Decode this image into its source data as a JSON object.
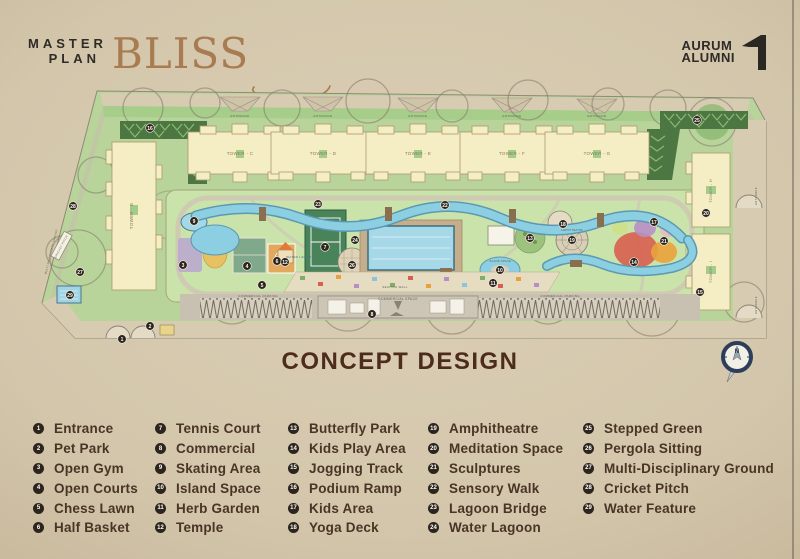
{
  "header": {
    "master_plan_line1": "MASTER",
    "master_plan_line2": "PLAN",
    "brand": "BLISS",
    "logo_line1": "AURUM",
    "logo_line2": "ALUMNI"
  },
  "title": "CONCEPT DESIGN",
  "colors": {
    "brand-gold": "#a87c50",
    "ink": "#2f2b26",
    "title-brown": "#4e2c1c",
    "legend-ink": "#4a3426",
    "marker-bg": "#2d251c",
    "site-green": "#b9d49b",
    "water-blue": "#8ccfe3"
  },
  "map": {
    "markers": [
      {
        "n": 1,
        "x": 122,
        "y": 339
      },
      {
        "n": 2,
        "x": 150,
        "y": 326
      },
      {
        "n": 3,
        "x": 183,
        "y": 265
      },
      {
        "n": 4,
        "x": 247,
        "y": 266
      },
      {
        "n": 5,
        "x": 262,
        "y": 285
      },
      {
        "n": 6,
        "x": 277,
        "y": 261
      },
      {
        "n": 7,
        "x": 325,
        "y": 247
      },
      {
        "n": 8,
        "x": 372,
        "y": 314
      },
      {
        "n": 9,
        "x": 194,
        "y": 221
      },
      {
        "n": 10,
        "x": 500,
        "y": 270
      },
      {
        "n": 11,
        "x": 493,
        "y": 283
      },
      {
        "n": 12,
        "x": 285,
        "y": 262
      },
      {
        "n": 13,
        "x": 530,
        "y": 238
      },
      {
        "n": 14,
        "x": 634,
        "y": 262
      },
      {
        "n": 15,
        "x": 700,
        "y": 292
      },
      {
        "n": 16,
        "x": 150,
        "y": 128
      },
      {
        "n": 17,
        "x": 654,
        "y": 222
      },
      {
        "n": 18,
        "x": 563,
        "y": 224
      },
      {
        "n": 19,
        "x": 572,
        "y": 240
      },
      {
        "n": 20,
        "x": 706,
        "y": 213
      },
      {
        "n": 21,
        "x": 664,
        "y": 241
      },
      {
        "n": 22,
        "x": 445,
        "y": 205
      },
      {
        "n": 23,
        "x": 318,
        "y": 204
      },
      {
        "n": 24,
        "x": 355,
        "y": 240
      },
      {
        "n": 25,
        "x": 697,
        "y": 120
      },
      {
        "n": 26,
        "x": 352,
        "y": 265
      },
      {
        "n": 27,
        "x": 80,
        "y": 272
      },
      {
        "n": 28,
        "x": 73,
        "y": 206
      },
      {
        "n": 29,
        "x": 70,
        "y": 295
      }
    ],
    "labels": [
      {
        "t": "ENTRANCE",
        "x": 240,
        "y": 117,
        "s": 3,
        "c": "#6b6352"
      },
      {
        "t": "ENTRANCE",
        "x": 323,
        "y": 117,
        "s": 3,
        "c": "#6b6352"
      },
      {
        "t": "ENTRANCE",
        "x": 418,
        "y": 117,
        "s": 3,
        "c": "#6b6352"
      },
      {
        "t": "ENTRANCE",
        "x": 512,
        "y": 117,
        "s": 3,
        "c": "#6b6352"
      },
      {
        "t": "ENTRANCE",
        "x": 597,
        "y": 117,
        "s": 3,
        "c": "#6b6352"
      },
      {
        "t": "TOWER - C",
        "x": 240,
        "y": 155,
        "s": 4.5
      },
      {
        "t": "TOWER - D",
        "x": 323,
        "y": 155,
        "s": 4.5
      },
      {
        "t": "TOWER - E",
        "x": 418,
        "y": 155,
        "s": 4.5
      },
      {
        "t": "TOWER - F",
        "x": 512,
        "y": 155,
        "s": 4.5
      },
      {
        "t": "TOWER - G",
        "x": 597,
        "y": 155,
        "s": 4.5
      },
      {
        "t": "TOWER - B",
        "x": 133,
        "y": 216,
        "r": -90,
        "s": 4.5
      },
      {
        "t": "TOWER - H",
        "x": 712,
        "y": 191,
        "r": -90,
        "s": 4
      },
      {
        "t": "TOWER - I",
        "x": 712,
        "y": 272,
        "r": -90,
        "s": 4
      },
      {
        "t": "ENTRANCE",
        "x": 757,
        "y": 196,
        "r": -90,
        "s": 2.8,
        "c": "#6b6352"
      },
      {
        "t": "ENTRANCE",
        "x": 757,
        "y": 305,
        "r": -90,
        "s": 2.8,
        "c": "#6b6352"
      },
      {
        "t": "CRICKET PITCH",
        "x": 62,
        "y": 247,
        "r": -62,
        "s": 2.8,
        "c": "#5a6b48"
      },
      {
        "t": "MULTI-DISCIPLINARY GROUND",
        "x": 52,
        "y": 252,
        "r": -76,
        "s": 2.6,
        "c": "#5a6b48"
      },
      {
        "t": "COMMERCIAL SPACE",
        "x": 398,
        "y": 300,
        "s": 3.4,
        "c": "#6b6352"
      },
      {
        "t": "COMMERCIAL PARKING",
        "x": 258,
        "y": 297,
        "s": 3,
        "c": "#6b6352"
      },
      {
        "t": "COMMERCIAL PARKING",
        "x": 560,
        "y": 297,
        "s": 3,
        "c": "#6b6352"
      },
      {
        "t": "SEATING WALL",
        "x": 395,
        "y": 288,
        "s": 3,
        "c": "#6b6352"
      },
      {
        "t": "WATER LAGOON",
        "x": 300,
        "y": 258,
        "s": 3,
        "c": "#3f708a"
      },
      {
        "t": "ISLAND SPACE",
        "x": 500,
        "y": 262,
        "s": 2.6,
        "c": "#6b5a3a"
      },
      {
        "t": "AMPHITHEATRE",
        "x": 572,
        "y": 231,
        "s": 2.4,
        "c": "#6b5a3a"
      },
      {
        "t": "N",
        "x": 737,
        "y": 353,
        "s": 6,
        "c": "#1f2d45",
        "w": 700
      }
    ]
  },
  "legend": {
    "columns": [
      {
        "items": [
          {
            "n": 1,
            "label": "Entrance"
          },
          {
            "n": 2,
            "label": "Pet Park"
          },
          {
            "n": 3,
            "label": "Open Gym"
          },
          {
            "n": 4,
            "label": "Open Courts"
          },
          {
            "n": 5,
            "label": "Chess Lawn"
          },
          {
            "n": 6,
            "label": "Half Basket"
          }
        ]
      },
      {
        "items": [
          {
            "n": 7,
            "label": "Tennis Court"
          },
          {
            "n": 8,
            "label": "Commercial"
          },
          {
            "n": 9,
            "label": "Skating Area"
          },
          {
            "n": 10,
            "label": "Island Space"
          },
          {
            "n": 11,
            "label": "Herb Garden"
          },
          {
            "n": 12,
            "label": "Temple"
          }
        ]
      },
      {
        "items": [
          {
            "n": 13,
            "label": "Butterfly Park"
          },
          {
            "n": 14,
            "label": "Kids Play Area"
          },
          {
            "n": 15,
            "label": "Jogging Track"
          },
          {
            "n": 16,
            "label": "Podium Ramp"
          },
          {
            "n": 17,
            "label": "Kids Area"
          },
          {
            "n": 18,
            "label": "Yoga Deck"
          }
        ]
      },
      {
        "items": [
          {
            "n": 19,
            "label": "Amphitheatre"
          },
          {
            "n": 20,
            "label": "Meditation Space"
          },
          {
            "n": 21,
            "label": "Sculptures"
          },
          {
            "n": 22,
            "label": "Sensory Walk"
          },
          {
            "n": 23,
            "label": "Lagoon Bridge"
          },
          {
            "n": 24,
            "label": "Water Lagoon"
          }
        ]
      },
      {
        "items": [
          {
            "n": 25,
            "label": "Stepped Green"
          },
          {
            "n": 26,
            "label": "Pergola Sitting"
          },
          {
            "n": 27,
            "label": "Multi-Disciplinary Ground"
          },
          {
            "n": 28,
            "label": "Cricket Pitch"
          },
          {
            "n": 29,
            "label": "Water Feature"
          }
        ]
      }
    ]
  }
}
